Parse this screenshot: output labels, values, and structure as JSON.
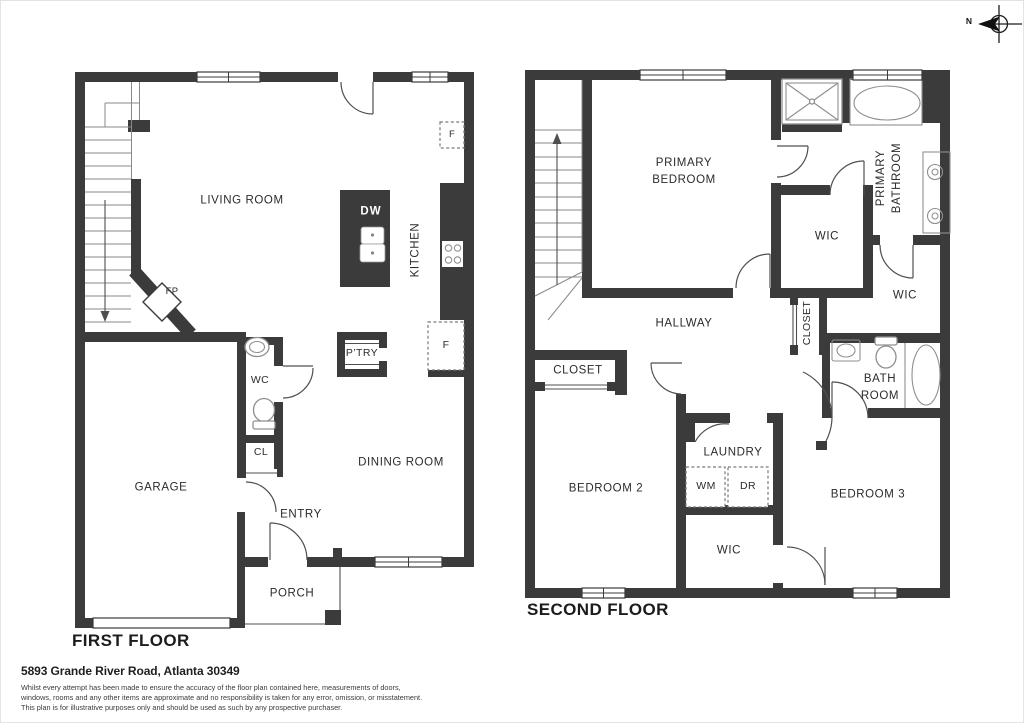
{
  "compass": {
    "north": "N"
  },
  "first_floor": {
    "title": "FIRST FLOOR",
    "labels": {
      "living_room": "LIVING ROOM",
      "kitchen": "KITCHEN",
      "dining_room": "DINING ROOM",
      "garage": "GARAGE",
      "wc": "WC",
      "closet": "CL",
      "entry": "ENTRY",
      "porch": "PORCH",
      "pantry": "P’TRY",
      "fireplace": "FP",
      "dishwasher": "DW",
      "fridge_upper": "F",
      "fridge_lower": "F"
    }
  },
  "second_floor": {
    "title": "SECOND FLOOR",
    "labels": {
      "primary_bedroom_1": "PRIMARY",
      "primary_bedroom_2": "BEDROOM",
      "primary_bathroom_1": "PRIMARY",
      "primary_bathroom_2": "BATHROOM",
      "hallway": "HALLWAY",
      "wic_primary": "WIC",
      "wic_hall": "WIC",
      "wic_bottom": "WIC",
      "closet_hall": "CLOSET",
      "closet_bedroom2": "CLOSET",
      "bath_1": "BATH",
      "bath_2": "ROOM",
      "laundry": "LAUNDRY",
      "washer": "WM",
      "dryer": "DR",
      "bedroom_2": "BEDROOM 2",
      "bedroom_3": "BEDROOM 3"
    }
  },
  "footer": {
    "address": "5893 Grande River Road, Atlanta 30349",
    "disclaimer": [
      "Whilst every attempt has been made to ensure the accuracy of the floor plan contained here, measurements of doors,",
      "windows, rooms and any other items are approximate and no responsibility is taken for any error, omission, or misstatement.",
      "This plan is for illustrative purposes only and should be used as such by any prospective purchaser."
    ]
  },
  "colors": {
    "wall": "#3b3b3b",
    "door_line": "#4f4f4f",
    "fixture_line": "#8f8f8f",
    "dashed_line": "#7a7a7a",
    "label_text": "#2b2b2b"
  }
}
